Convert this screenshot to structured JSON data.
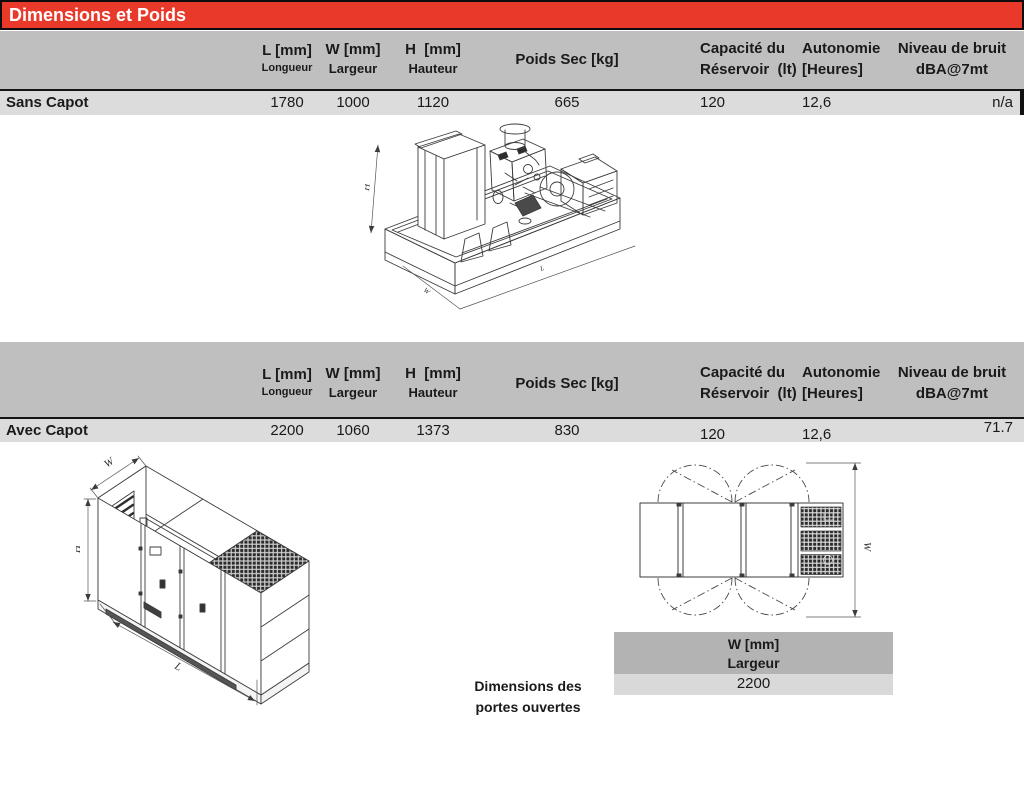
{
  "page": {
    "title": "Dimensions et Poids"
  },
  "table_columns": {
    "l_main": "L [mm]",
    "l_sub": "Longueur",
    "w_main": "W [mm]",
    "w_sub": "Largeur",
    "h_main": "H  [mm]",
    "h_sub": "Hauteur",
    "poids": "Poids Sec [kg]",
    "capacite_1": "Capacité du",
    "capacite_2": "Réservoir  (lt)",
    "autonomie_1": "Autonomie",
    "autonomie_2": "[Heures]",
    "bruit_1": "Niveau de bruit",
    "bruit_2": "dBA@7mt"
  },
  "sans_capot": {
    "label": "Sans Capot",
    "l": "1780",
    "w": "1000",
    "h": "1120",
    "poids": "665",
    "capacite": "120",
    "autonomie": "12,6",
    "bruit": "n/a"
  },
  "avec_capot": {
    "label": "Avec Capot",
    "l": "2200",
    "w": "1060",
    "h": "1373",
    "poids": "830",
    "capacite": "120",
    "autonomie": "12,6",
    "bruit": "71.7"
  },
  "open_doors": {
    "caption_1": "Dimensions des",
    "caption_2": "portes ouvertes",
    "header_main": "W [mm]",
    "header_sub": "Largeur",
    "value": "2200"
  },
  "dim_labels": {
    "h": "H",
    "w": "W",
    "l": "L"
  },
  "colors": {
    "accent_red": "#e8392b",
    "band_gray": "#bfbfbf",
    "row_gray": "#dcdcdc",
    "mini_header_gray": "#b3b3b3",
    "mini_row_gray": "#d9d9d9",
    "line_black": "#141414",
    "drawing_stroke": "#3c3c3c"
  }
}
